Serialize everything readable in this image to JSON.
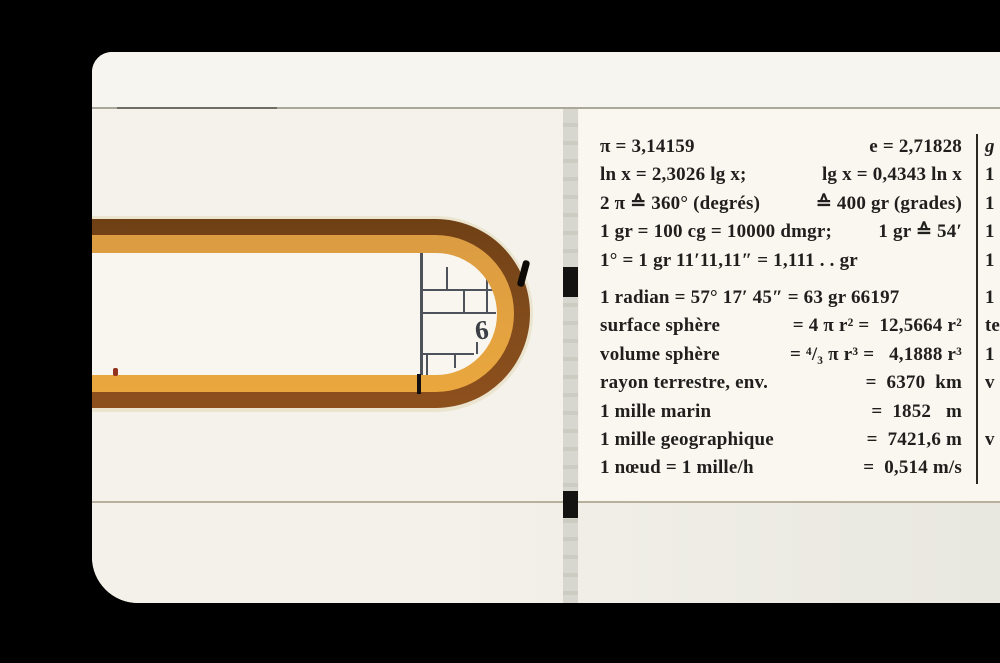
{
  "panel": {
    "lines": [
      {
        "left": "π = 3,14159",
        "right": "e = 2,71828"
      },
      {
        "left": "ln x = 2,3026 lg x;",
        "right": "lg x = 0,4343 ln x"
      },
      {
        "left": "2 π ≙ 360° (degrés)",
        "right": "≙ 400 gr (grades)"
      },
      {
        "left": "1 gr = 100 cg = 10000 dmgr;",
        "right": "1 gr ≙ 54′"
      },
      {
        "left": "1° = 1 gr 11′11,11″ = 1,111 . . gr",
        "right": ""
      },
      {
        "left": "1 radian = 57° 17′ 45″ = 63 gr 66197",
        "right": ""
      },
      {
        "left": "surface sphère",
        "right": "= 4 π r² =  12,5664 r²"
      },
      {
        "left": "volume sphère",
        "right": "= ⁴/₃ π r³ =   4,1888 r³"
      },
      {
        "left": "rayon terrestre, env.",
        "right": "=  6370  km"
      },
      {
        "left": "1 mille marin",
        "right": "=  1852   m"
      },
      {
        "left": "1 mille geographique",
        "right": "=  7421,6 m"
      },
      {
        "left": "1 nœud = 1 mille/h",
        "right": "=  0,514 m/s"
      }
    ],
    "margin_chars": [
      "g",
      "1",
      "1",
      "1",
      "1",
      "1",
      "te",
      "1",
      "v",
      "v"
    ]
  },
  "scale_window": {
    "digit": "6"
  },
  "colors": {
    "background": "#000000",
    "body_white": "#f4f2ea",
    "wood_dark": "#7f4a1b",
    "wood_orange": "#e2a342",
    "ink": "#201f1d",
    "scale_line": "#4e525a"
  }
}
